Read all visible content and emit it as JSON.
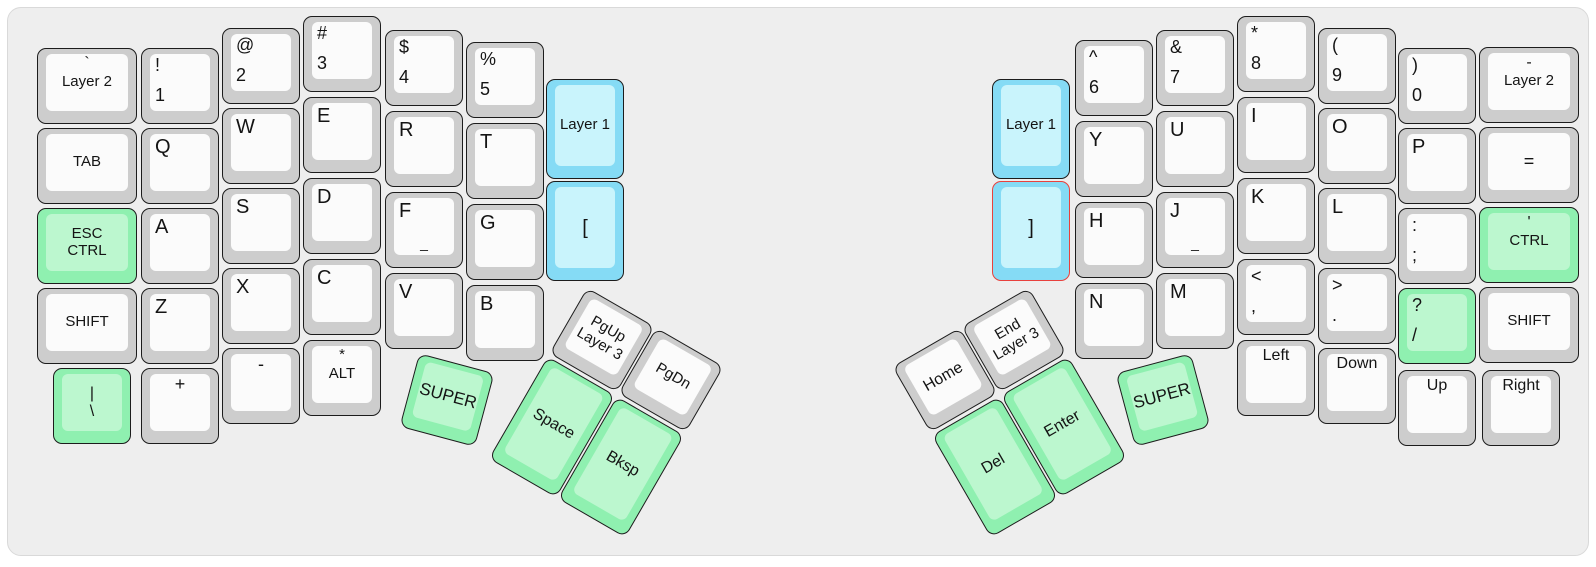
{
  "panel": {
    "x": 7,
    "y": 7,
    "w": 1582,
    "h": 549
  },
  "colors": {
    "page_bg": "#ffffff",
    "panel_bg": "#eeeeee",
    "panel_border": "#d9d9d9",
    "key_border": "#1c1c1c",
    "text": "#141414",
    "gray_outer": "#cdcdcd",
    "gray_inner": "#fbfbfb",
    "green_outer": "#8ff0b0",
    "green_inner": "#bcf7cf",
    "blue_outer": "#85dbf5",
    "blue_inner": "#c9f4fc",
    "red_border": "#e8413d"
  },
  "unit": {
    "w": 78,
    "h": 76,
    "wide_w": 100,
    "tall_h": 100,
    "thumb_tall_h": 118
  },
  "keys": [
    {
      "name": "super-left",
      "cx": 447,
      "cy": 400,
      "rot": 15,
      "color": "green",
      "legends": [
        {
          "pos": "c",
          "text": "SUPER",
          "size": 17
        }
      ]
    },
    {
      "name": "space",
      "cx": 552,
      "cy": 427,
      "rot": 30,
      "h": 118,
      "color": "green",
      "legends": [
        {
          "pos": "c",
          "text": "Space",
          "size": 16
        }
      ]
    },
    {
      "name": "bksp",
      "cx": 621,
      "cy": 467,
      "rot": 30,
      "h": 118,
      "color": "green",
      "legends": [
        {
          "pos": "c",
          "text": "Bksp",
          "size": 16
        }
      ]
    },
    {
      "name": "pgup-layer3",
      "cx": 602,
      "cy": 340,
      "rot": 30,
      "color": "gray",
      "legends": [
        {
          "pos": "c",
          "text": "PgUp",
          "size": 15
        },
        {
          "pos": "c",
          "text": "Layer 3",
          "size": 15
        }
      ]
    },
    {
      "name": "pgdn",
      "cx": 671,
      "cy": 380,
      "rot": 30,
      "color": "gray",
      "legends": [
        {
          "pos": "c",
          "text": "PgDn",
          "size": 15
        }
      ]
    },
    {
      "name": "layer2-left",
      "x": 37,
      "y": 48,
      "w": 100,
      "color": "gray",
      "legends": [
        {
          "pos": "tc",
          "text": "`",
          "size": 16
        },
        {
          "pos": "c",
          "text": "Layer 2",
          "size": 15
        }
      ]
    },
    {
      "name": "tab",
      "x": 37,
      "y": 128,
      "w": 100,
      "color": "gray",
      "legends": [
        {
          "pos": "c",
          "text": "TAB",
          "size": 15
        }
      ]
    },
    {
      "name": "esc-ctrl",
      "x": 37,
      "y": 208,
      "w": 100,
      "color": "green",
      "legends": [
        {
          "pos": "c",
          "text": "ESC",
          "size": 15
        },
        {
          "pos": "c",
          "text": "CTRL",
          "size": 15
        }
      ]
    },
    {
      "name": "shift-left",
      "x": 37,
      "y": 288,
      "w": 100,
      "color": "gray",
      "legends": [
        {
          "pos": "c",
          "text": "SHIFT",
          "size": 15
        }
      ]
    },
    {
      "name": "pipe-backslash",
      "x": 53,
      "y": 368,
      "color": "green",
      "legends": [
        {
          "pos": "c",
          "text": "|",
          "size": 16
        },
        {
          "pos": "c",
          "text": "\\",
          "size": 16
        }
      ]
    },
    {
      "name": "exclam-1",
      "x": 141,
      "y": 48,
      "color": "gray",
      "legends": [
        {
          "pos": "tl",
          "text": "!",
          "size": 18
        },
        {
          "pos": "bl",
          "text": "1",
          "size": 18
        }
      ]
    },
    {
      "name": "q",
      "x": 141,
      "y": 128,
      "color": "gray",
      "legends": [
        {
          "pos": "tl",
          "text": "Q",
          "size": 20
        }
      ]
    },
    {
      "name": "a",
      "x": 141,
      "y": 208,
      "color": "gray",
      "legends": [
        {
          "pos": "tl",
          "text": "A",
          "size": 20
        }
      ]
    },
    {
      "name": "z",
      "x": 141,
      "y": 288,
      "color": "gray",
      "legends": [
        {
          "pos": "tl",
          "text": "Z",
          "size": 20
        }
      ]
    },
    {
      "name": "plus",
      "x": 141,
      "y": 368,
      "color": "gray",
      "legends": [
        {
          "pos": "tc",
          "text": "+",
          "size": 18
        }
      ]
    },
    {
      "name": "at-2",
      "x": 222,
      "y": 28,
      "color": "gray",
      "legends": [
        {
          "pos": "tl",
          "text": "@",
          "size": 18
        },
        {
          "pos": "bl",
          "text": "2",
          "size": 18
        }
      ]
    },
    {
      "name": "w",
      "x": 222,
      "y": 108,
      "color": "gray",
      "legends": [
        {
          "pos": "tl",
          "text": "W",
          "size": 20
        }
      ]
    },
    {
      "name": "s",
      "x": 222,
      "y": 188,
      "color": "gray",
      "legends": [
        {
          "pos": "tl",
          "text": "S",
          "size": 20
        }
      ]
    },
    {
      "name": "x",
      "x": 222,
      "y": 268,
      "color": "gray",
      "legends": [
        {
          "pos": "tl",
          "text": "X",
          "size": 20
        }
      ]
    },
    {
      "name": "minus",
      "x": 222,
      "y": 348,
      "color": "gray",
      "legends": [
        {
          "pos": "tc",
          "text": "-",
          "size": 18
        }
      ]
    },
    {
      "name": "hash-3",
      "x": 303,
      "y": 16,
      "color": "gray",
      "legends": [
        {
          "pos": "tl",
          "text": "#",
          "size": 18
        },
        {
          "pos": "bl",
          "text": "3",
          "size": 18
        }
      ]
    },
    {
      "name": "e",
      "x": 303,
      "y": 97,
      "color": "gray",
      "legends": [
        {
          "pos": "tl",
          "text": "E",
          "size": 20
        }
      ]
    },
    {
      "name": "d",
      "x": 303,
      "y": 178,
      "color": "gray",
      "legends": [
        {
          "pos": "tl",
          "text": "D",
          "size": 20
        }
      ]
    },
    {
      "name": "c",
      "x": 303,
      "y": 259,
      "color": "gray",
      "legends": [
        {
          "pos": "tl",
          "text": "C",
          "size": 20
        }
      ]
    },
    {
      "name": "asterisk-alt",
      "x": 303,
      "y": 340,
      "color": "gray",
      "legends": [
        {
          "pos": "tc",
          "text": "*",
          "size": 15
        },
        {
          "pos": "c",
          "text": "ALT",
          "size": 15
        }
      ]
    },
    {
      "name": "dollar-4",
      "x": 385,
      "y": 30,
      "color": "gray",
      "legends": [
        {
          "pos": "tl",
          "text": "$",
          "size": 18
        },
        {
          "pos": "bl",
          "text": "4",
          "size": 18
        }
      ]
    },
    {
      "name": "r",
      "x": 385,
      "y": 111,
      "color": "gray",
      "legends": [
        {
          "pos": "tl",
          "text": "R",
          "size": 20
        }
      ]
    },
    {
      "name": "f",
      "x": 385,
      "y": 192,
      "color": "gray",
      "legends": [
        {
          "pos": "tl",
          "text": "F",
          "size": 20
        },
        {
          "pos": "bc",
          "text": "_",
          "size": 14
        }
      ]
    },
    {
      "name": "v",
      "x": 385,
      "y": 273,
      "color": "gray",
      "legends": [
        {
          "pos": "tl",
          "text": "V",
          "size": 20
        }
      ]
    },
    {
      "name": "percent-5",
      "x": 466,
      "y": 42,
      "color": "gray",
      "legends": [
        {
          "pos": "tl",
          "text": "%",
          "size": 18
        },
        {
          "pos": "bl",
          "text": "5",
          "size": 18
        }
      ]
    },
    {
      "name": "t",
      "x": 466,
      "y": 123,
      "color": "gray",
      "legends": [
        {
          "pos": "tl",
          "text": "T",
          "size": 20
        }
      ]
    },
    {
      "name": "g",
      "x": 466,
      "y": 204,
      "color": "gray",
      "legends": [
        {
          "pos": "tl",
          "text": "G",
          "size": 20
        }
      ]
    },
    {
      "name": "b",
      "x": 466,
      "y": 285,
      "color": "gray",
      "legends": [
        {
          "pos": "tl",
          "text": "B",
          "size": 20
        }
      ]
    },
    {
      "name": "layer1-left",
      "x": 546,
      "y": 79,
      "h": 100,
      "color": "blue",
      "legends": [
        {
          "pos": "c",
          "text": "Layer 1",
          "size": 15
        }
      ]
    },
    {
      "name": "open-bracket",
      "x": 546,
      "y": 181,
      "h": 100,
      "color": "blue",
      "legends": [
        {
          "pos": "c",
          "text": "[",
          "size": 20
        }
      ]
    },
    {
      "name": "super-right",
      "cx": 1163,
      "cy": 400,
      "rot": -15,
      "color": "green",
      "legends": [
        {
          "pos": "c",
          "text": "SUPER",
          "size": 17
        }
      ]
    },
    {
      "name": "enter",
      "cx": 1064,
      "cy": 427,
      "rot": -30,
      "h": 118,
      "color": "green",
      "legends": [
        {
          "pos": "c",
          "text": "Enter",
          "size": 16
        }
      ]
    },
    {
      "name": "del",
      "cx": 995,
      "cy": 467,
      "rot": -30,
      "h": 118,
      "color": "green",
      "legends": [
        {
          "pos": "c",
          "text": "Del",
          "size": 16
        }
      ]
    },
    {
      "name": "home",
      "cx": 945,
      "cy": 380,
      "rot": -30,
      "color": "gray",
      "legends": [
        {
          "pos": "c",
          "text": "Home",
          "size": 16
        }
      ]
    },
    {
      "name": "end-layer3",
      "cx": 1014,
      "cy": 340,
      "rot": -30,
      "color": "gray",
      "legends": [
        {
          "pos": "c",
          "text": "End",
          "size": 15
        },
        {
          "pos": "c",
          "text": "Layer 3",
          "size": 15
        }
      ]
    },
    {
      "name": "layer1-right",
      "x": 992,
      "y": 79,
      "h": 100,
      "color": "blue",
      "legends": [
        {
          "pos": "c",
          "text": "Layer 1",
          "size": 15
        }
      ]
    },
    {
      "name": "close-bracket",
      "x": 992,
      "y": 181,
      "h": 100,
      "color": "blue",
      "border": "red",
      "legends": [
        {
          "pos": "c",
          "text": "]",
          "size": 20
        }
      ]
    },
    {
      "name": "caret-6",
      "x": 1075,
      "y": 40,
      "color": "gray",
      "legends": [
        {
          "pos": "tl",
          "text": "^",
          "size": 18
        },
        {
          "pos": "bl",
          "text": "6",
          "size": 18
        }
      ]
    },
    {
      "name": "y",
      "x": 1075,
      "y": 121,
      "color": "gray",
      "legends": [
        {
          "pos": "tl",
          "text": "Y",
          "size": 20
        }
      ]
    },
    {
      "name": "h",
      "x": 1075,
      "y": 202,
      "color": "gray",
      "legends": [
        {
          "pos": "tl",
          "text": "H",
          "size": 20
        }
      ]
    },
    {
      "name": "n",
      "x": 1075,
      "y": 283,
      "color": "gray",
      "legends": [
        {
          "pos": "tl",
          "text": "N",
          "size": 20
        }
      ]
    },
    {
      "name": "ampersand-7",
      "x": 1156,
      "y": 30,
      "color": "gray",
      "legends": [
        {
          "pos": "tl",
          "text": "&",
          "size": 18
        },
        {
          "pos": "bl",
          "text": "7",
          "size": 18
        }
      ]
    },
    {
      "name": "u",
      "x": 1156,
      "y": 111,
      "color": "gray",
      "legends": [
        {
          "pos": "tl",
          "text": "U",
          "size": 20
        }
      ]
    },
    {
      "name": "j",
      "x": 1156,
      "y": 192,
      "color": "gray",
      "legends": [
        {
          "pos": "tl",
          "text": "J",
          "size": 20
        },
        {
          "pos": "bc",
          "text": "_",
          "size": 14
        }
      ]
    },
    {
      "name": "m",
      "x": 1156,
      "y": 273,
      "color": "gray",
      "legends": [
        {
          "pos": "tl",
          "text": "M",
          "size": 20
        }
      ]
    },
    {
      "name": "asterisk-8",
      "x": 1237,
      "y": 16,
      "color": "gray",
      "legends": [
        {
          "pos": "tl",
          "text": "*",
          "size": 18
        },
        {
          "pos": "bl",
          "text": "8",
          "size": 18
        }
      ]
    },
    {
      "name": "i",
      "x": 1237,
      "y": 97,
      "color": "gray",
      "legends": [
        {
          "pos": "tl",
          "text": "I",
          "size": 20
        }
      ]
    },
    {
      "name": "k",
      "x": 1237,
      "y": 178,
      "color": "gray",
      "legends": [
        {
          "pos": "tl",
          "text": "K",
          "size": 20
        }
      ]
    },
    {
      "name": "less-comma",
      "x": 1237,
      "y": 259,
      "color": "gray",
      "legends": [
        {
          "pos": "tl",
          "text": "<",
          "size": 18
        },
        {
          "pos": "bl",
          "text": ",",
          "size": 18
        }
      ]
    },
    {
      "name": "left-arrow",
      "x": 1237,
      "y": 340,
      "color": "gray",
      "legends": [
        {
          "pos": "tc",
          "text": "Left",
          "size": 16
        }
      ]
    },
    {
      "name": "paren-9",
      "x": 1318,
      "y": 28,
      "color": "gray",
      "legends": [
        {
          "pos": "tl",
          "text": "(",
          "size": 18
        },
        {
          "pos": "bl",
          "text": "9",
          "size": 18
        }
      ]
    },
    {
      "name": "o",
      "x": 1318,
      "y": 108,
      "color": "gray",
      "legends": [
        {
          "pos": "tl",
          "text": "O",
          "size": 20
        }
      ]
    },
    {
      "name": "l",
      "x": 1318,
      "y": 188,
      "color": "gray",
      "legends": [
        {
          "pos": "tl",
          "text": "L",
          "size": 20
        }
      ]
    },
    {
      "name": "greater-period",
      "x": 1318,
      "y": 268,
      "color": "gray",
      "legends": [
        {
          "pos": "tl",
          "text": ">",
          "size": 18
        },
        {
          "pos": "bl",
          "text": ".",
          "size": 18
        }
      ]
    },
    {
      "name": "down-arrow",
      "x": 1318,
      "y": 348,
      "color": "gray",
      "legends": [
        {
          "pos": "tc",
          "text": "Down",
          "size": 16
        }
      ]
    },
    {
      "name": "paren-0",
      "x": 1398,
      "y": 48,
      "color": "gray",
      "legends": [
        {
          "pos": "tl",
          "text": ")",
          "size": 18
        },
        {
          "pos": "bl",
          "text": "0",
          "size": 18
        }
      ]
    },
    {
      "name": "p",
      "x": 1398,
      "y": 128,
      "color": "gray",
      "legends": [
        {
          "pos": "tl",
          "text": "P",
          "size": 20
        }
      ]
    },
    {
      "name": "colon-semicolon",
      "x": 1398,
      "y": 208,
      "color": "gray",
      "legends": [
        {
          "pos": "tl",
          "text": ":",
          "size": 18
        },
        {
          "pos": "bl",
          "text": ";",
          "size": 18
        }
      ]
    },
    {
      "name": "question-slash",
      "x": 1398,
      "y": 288,
      "color": "green",
      "legends": [
        {
          "pos": "tl",
          "text": "?",
          "size": 18
        },
        {
          "pos": "bl",
          "text": "/",
          "size": 18
        }
      ]
    },
    {
      "name": "up-arrow",
      "x": 1398,
      "y": 370,
      "color": "gray",
      "legends": [
        {
          "pos": "tc",
          "text": "Up",
          "size": 16
        }
      ]
    },
    {
      "name": "layer2-right",
      "x": 1479,
      "y": 47,
      "w": 100,
      "color": "gray",
      "legends": [
        {
          "pos": "tc",
          "text": "-",
          "size": 16
        },
        {
          "pos": "c",
          "text": "Layer 2",
          "size": 15
        }
      ]
    },
    {
      "name": "equals",
      "x": 1479,
      "y": 127,
      "w": 100,
      "color": "gray",
      "legends": [
        {
          "pos": "c",
          "text": "=",
          "size": 18
        }
      ]
    },
    {
      "name": "quote-ctrl",
      "x": 1479,
      "y": 207,
      "w": 100,
      "color": "green",
      "legends": [
        {
          "pos": "tc",
          "text": "'",
          "size": 16
        },
        {
          "pos": "c",
          "text": "CTRL",
          "size": 15
        }
      ]
    },
    {
      "name": "shift-right",
      "x": 1479,
      "y": 287,
      "w": 100,
      "color": "gray",
      "legends": [
        {
          "pos": "c",
          "text": "SHIFT",
          "size": 15
        }
      ]
    },
    {
      "name": "right-arrow",
      "x": 1482,
      "y": 370,
      "color": "gray",
      "legends": [
        {
          "pos": "tc",
          "text": "Right",
          "size": 16
        }
      ]
    }
  ]
}
